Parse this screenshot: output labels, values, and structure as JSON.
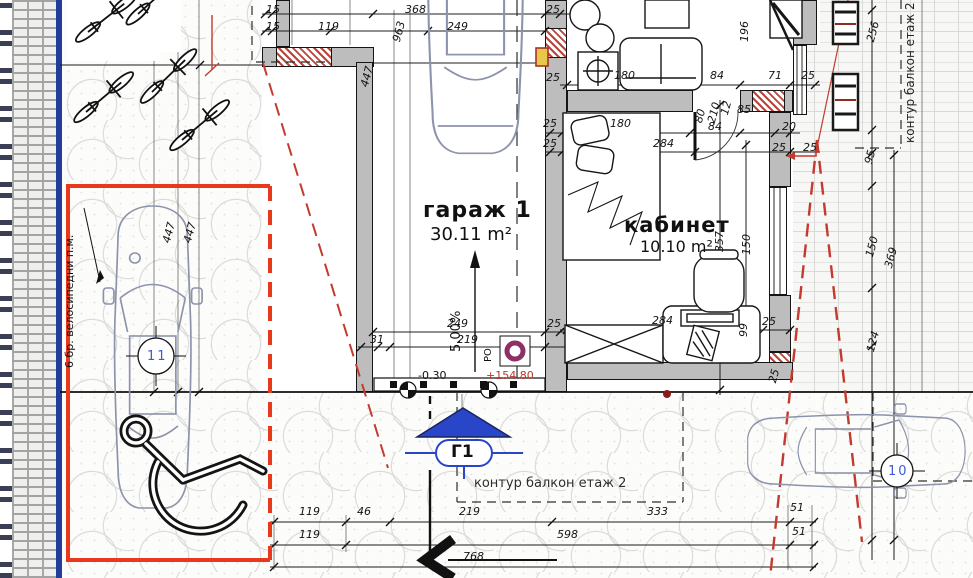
{
  "plan": {
    "rooms": [
      {
        "name": "гараж 1",
        "area": "30.11 m²",
        "slope": "5.00%"
      },
      {
        "name": "кабинет",
        "area": "10.10 m²"
      }
    ],
    "parking": {
      "left_space_number": "11",
      "right_space_number": "10",
      "bike_label": "6 бр. велосипедни п.м."
    },
    "annotations": {
      "balcony_contour_bottom": "контур балкон етаж 2",
      "balcony_contour_right": "контур балкон етаж 2",
      "entrance_marker": "Г1",
      "drain": "РО",
      "level_relative": "-0.30",
      "level_absolute": "+154.80"
    },
    "colors": {
      "parking_outline": "#e8391d",
      "entrance_blue": "#2a46c8",
      "dashed_red": "#c23b2e",
      "wall_gray": "#bdbdbd",
      "hatch_red": "#b8443a",
      "curb_blue": "#1f3d99",
      "drain_ring": "#8e2f66",
      "level_red": "#b03a2e",
      "car_stroke": "#8d93ab",
      "space_number_blue": "#3b5bd6"
    },
    "dimensions": [
      {
        "t": "15",
        "x": 266,
        "y": 3
      },
      {
        "t": "15",
        "x": 266,
        "y": 20
      },
      {
        "t": "119",
        "x": 318,
        "y": 20
      },
      {
        "t": "963",
        "x": 390,
        "y": 40,
        "r": -75
      },
      {
        "t": "368",
        "x": 405,
        "y": 3
      },
      {
        "t": "249",
        "x": 447,
        "y": 20
      },
      {
        "t": "25",
        "x": 546,
        "y": 3
      },
      {
        "t": "25",
        "x": 546,
        "y": 71
      },
      {
        "t": "180",
        "x": 614,
        "y": 69
      },
      {
        "t": "196",
        "x": 738,
        "y": 42,
        "r": -90
      },
      {
        "t": "84",
        "x": 710,
        "y": 69
      },
      {
        "t": "71",
        "x": 768,
        "y": 69
      },
      {
        "t": "25",
        "x": 801,
        "y": 69
      },
      {
        "t": "80",
        "x": 692,
        "y": 121,
        "r": -75
      },
      {
        "t": "210",
        "x": 705,
        "y": 121,
        "r": -75
      },
      {
        "t": "12",
        "x": 718,
        "y": 113,
        "r": -75
      },
      {
        "t": "85",
        "x": 737,
        "y": 103
      },
      {
        "t": "25",
        "x": 543,
        "y": 117
      },
      {
        "t": "180",
        "x": 610,
        "y": 117
      },
      {
        "t": "84",
        "x": 708,
        "y": 120
      },
      {
        "t": "20",
        "x": 782,
        "y": 120
      },
      {
        "t": "25",
        "x": 543,
        "y": 137
      },
      {
        "t": "284",
        "x": 653,
        "y": 137
      },
      {
        "t": "25",
        "x": 772,
        "y": 141
      },
      {
        "t": "25",
        "x": 803,
        "y": 141
      },
      {
        "t": "357",
        "x": 713,
        "y": 252,
        "r": -90
      },
      {
        "t": "150",
        "x": 740,
        "y": 255,
        "r": -90
      },
      {
        "t": "256",
        "x": 864,
        "y": 40,
        "r": -75
      },
      {
        "t": "95",
        "x": 862,
        "y": 162,
        "r": -75
      },
      {
        "t": "150",
        "x": 863,
        "y": 255,
        "r": -75
      },
      {
        "t": "369",
        "x": 882,
        "y": 266,
        "r": -75
      },
      {
        "t": "124",
        "x": 864,
        "y": 350,
        "r": -75
      },
      {
        "t": "447",
        "x": 358,
        "y": 85,
        "r": -75
      },
      {
        "t": "447",
        "x": 160,
        "y": 241,
        "r": -75
      },
      {
        "t": "447",
        "x": 181,
        "y": 241,
        "r": -75
      },
      {
        "t": "249",
        "x": 447,
        "y": 317
      },
      {
        "t": "31",
        "x": 370,
        "y": 333
      },
      {
        "t": "219",
        "x": 457,
        "y": 333
      },
      {
        "t": "25",
        "x": 547,
        "y": 317
      },
      {
        "t": "284",
        "x": 652,
        "y": 314
      },
      {
        "t": "99",
        "x": 737,
        "y": 337,
        "r": -90
      },
      {
        "t": "25",
        "x": 762,
        "y": 315
      },
      {
        "t": "25",
        "x": 766,
        "y": 381,
        "r": -75
      },
      {
        "t": "119",
        "x": 299,
        "y": 505
      },
      {
        "t": "46",
        "x": 357,
        "y": 505
      },
      {
        "t": "219",
        "x": 459,
        "y": 505
      },
      {
        "t": "333",
        "x": 647,
        "y": 505
      },
      {
        "t": "51",
        "x": 790,
        "y": 501
      },
      {
        "t": "119",
        "x": 299,
        "y": 528
      },
      {
        "t": "598",
        "x": 557,
        "y": 528
      },
      {
        "t": "51",
        "x": 792,
        "y": 525
      },
      {
        "t": "768",
        "x": 463,
        "y": 550
      }
    ]
  }
}
